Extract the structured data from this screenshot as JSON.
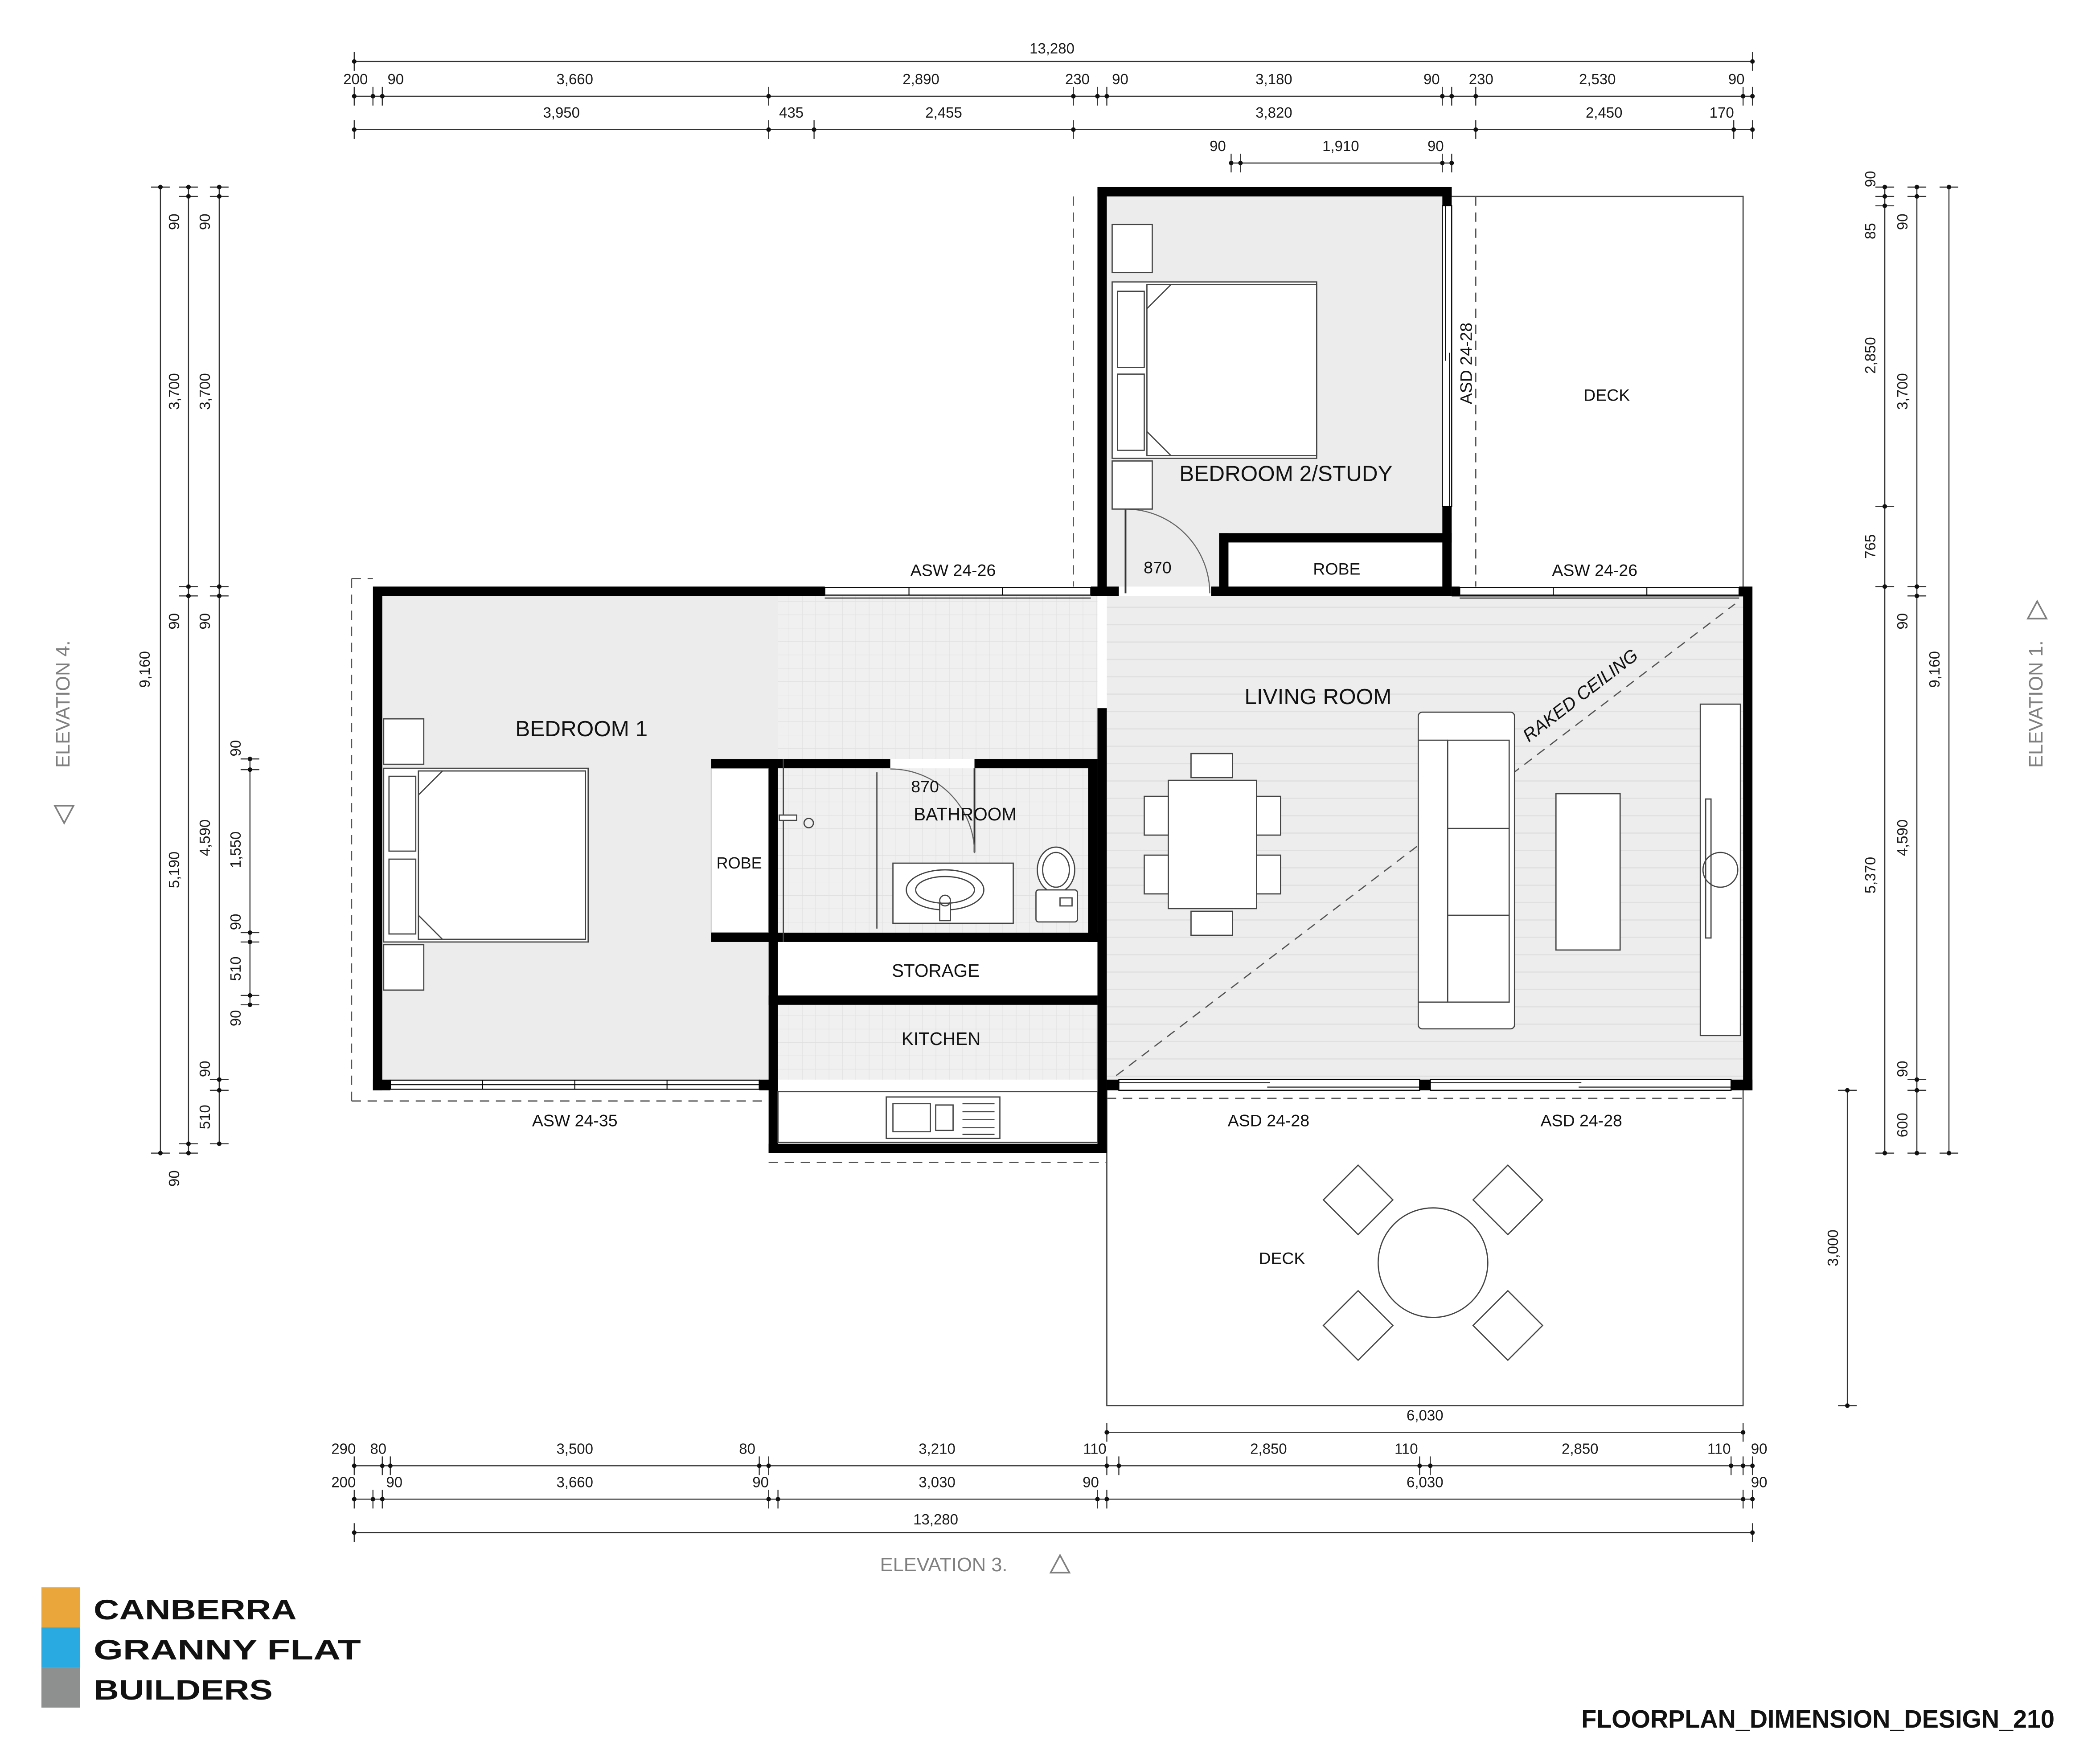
{
  "title": "FLOORPLAN_DIMENSION_DESIGN_210",
  "logo": {
    "line1": "CANBERRA",
    "line2": "GRANNY FLAT",
    "line3": "BUILDERS"
  },
  "colors": {
    "logo_orange": "#EBA63B",
    "logo_blue": "#29ABE2",
    "logo_gray": "#8E9090",
    "room_fill": "#ececec",
    "wall": "#000000"
  },
  "rooms": {
    "bedroom1": "BEDROOM 1",
    "bedroom2": "BEDROOM 2/STUDY",
    "living": "LIVING ROOM",
    "bathroom": "BATHROOM",
    "kitchen": "KITCHEN",
    "storage": "STORAGE",
    "robe1": "ROBE",
    "robe2": "ROBE",
    "deck_top": "DECK",
    "deck_bottom": "DECK",
    "raked_ceiling": "RAKED CEILING"
  },
  "openings": {
    "asw_mid_left": "ASW 24-26",
    "asw_mid_right": "ASW 24-26",
    "asw_south": "ASW 24-35",
    "asd_east": "ASD 24-28",
    "asd_south_1": "ASD 24-28",
    "asd_south_2": "ASD 24-28",
    "door_bed2": "870",
    "door_bath": "870"
  },
  "elevations": {
    "e1": "ELEVATION 1.",
    "e3": "ELEVATION 3.",
    "e4": "ELEVATION 4."
  },
  "dimensions": {
    "top": {
      "row1": "13,280",
      "row2": [
        "200",
        "90",
        "3,660",
        "2,890",
        "230",
        "90",
        "3,180",
        "90",
        "230",
        "2,530",
        "90"
      ],
      "row3": [
        "3,950",
        "435",
        "2,455",
        "3,820",
        "2,450",
        "170"
      ],
      "row4": [
        "90",
        "1,910",
        "90"
      ]
    },
    "bottom": {
      "deck": "6,030",
      "row1": [
        "290",
        "80",
        "3,500",
        "80",
        "3,210",
        "110",
        "2,850",
        "110",
        "2,850",
        "110",
        "90"
      ],
      "row2": [
        "200",
        "90",
        "3,660",
        "90",
        "3,030",
        "90",
        "6,030",
        "90"
      ],
      "row3": "13,280"
    },
    "left": {
      "overall": "9,160",
      "col2": [
        "90",
        "3,700",
        "90",
        "5,190",
        "90"
      ],
      "col3": [
        "90",
        "3,700",
        "90",
        "4,590",
        "90",
        "510"
      ],
      "col4": [
        "90",
        "1,550",
        "90",
        "510",
        "90"
      ]
    },
    "right": {
      "overall": "9,160",
      "inner": [
        "90",
        "85",
        "2,850",
        "765",
        "5,370"
      ],
      "mid": [
        "90",
        "3,700",
        "90",
        "4,590",
        "90",
        "600"
      ],
      "deck": "3,000"
    }
  }
}
